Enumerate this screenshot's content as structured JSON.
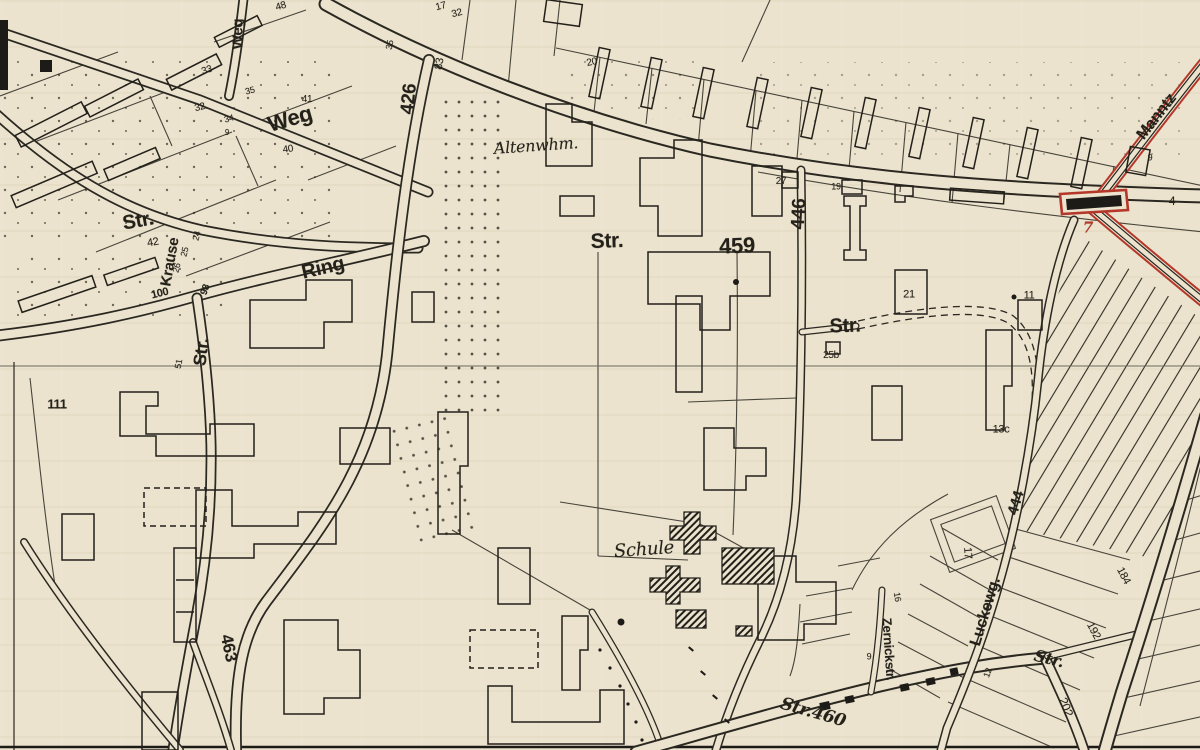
{
  "map": {
    "type": "scanned-city-plan",
    "language": "German",
    "paper_color": "#ebe3cd",
    "ink_color": "#2b2822",
    "highlight_color": "#b4372a",
    "labels": [
      {
        "text": "Weg",
        "x": 238,
        "y": 34,
        "rot": -90,
        "size": 15,
        "bold": true
      },
      {
        "text": "Weg",
        "x": 290,
        "y": 119,
        "rot": -16,
        "size": 22,
        "bold": true
      },
      {
        "text": "Str.",
        "x": 138,
        "y": 221,
        "rot": -10,
        "size": 20,
        "bold": true
      },
      {
        "text": "Krause",
        "x": 170,
        "y": 262,
        "rot": -80,
        "size": 15,
        "bold": true
      },
      {
        "text": "Ring",
        "x": 323,
        "y": 268,
        "rot": -13,
        "size": 20,
        "bold": true
      },
      {
        "text": "Str.",
        "x": 201,
        "y": 352,
        "rot": -84,
        "size": 18,
        "bold": true
      },
      {
        "text": "426",
        "x": 409,
        "y": 99,
        "rot": -84,
        "size": 19,
        "bold": true
      },
      {
        "text": "463",
        "x": 229,
        "y": 648,
        "rot": 78,
        "size": 17,
        "bold": true
      },
      {
        "text": "446",
        "x": 799,
        "y": 214,
        "rot": -87,
        "size": 19,
        "bold": true
      },
      {
        "text": "459",
        "x": 737,
        "y": 246,
        "rot": -2,
        "size": 22,
        "bold": true
      },
      {
        "text": "Str.",
        "x": 607,
        "y": 241,
        "rot": -2,
        "size": 21,
        "bold": true
      },
      {
        "text": "Altenwhm.",
        "x": 536,
        "y": 146,
        "rot": -4,
        "size": 16,
        "italic": true
      },
      {
        "text": "Schule",
        "x": 644,
        "y": 550,
        "rot": -4,
        "size": 18,
        "italic": true
      },
      {
        "text": "Str.",
        "x": 845,
        "y": 326,
        "rot": -2,
        "size": 20,
        "bold": true
      },
      {
        "text": "Str.460",
        "x": 813,
        "y": 713,
        "rot": 16,
        "size": 17,
        "bold": true,
        "italic": true
      },
      {
        "text": "Str.",
        "x": 1049,
        "y": 659,
        "rot": 14,
        "size": 16,
        "bold": true,
        "italic": true
      },
      {
        "text": "Zernickstr.",
        "x": 889,
        "y": 649,
        "rot": 86,
        "size": 13,
        "bold": true
      },
      {
        "text": "Luckewg.",
        "x": 986,
        "y": 612,
        "rot": -73,
        "size": 16,
        "bold": true
      },
      {
        "text": "444",
        "x": 1016,
        "y": 503,
        "rot": -73,
        "size": 15,
        "bold": true
      },
      {
        "text": "Manntz",
        "x": 1157,
        "y": 117,
        "rot": -52,
        "size": 16,
        "bold": true
      },
      {
        "text": "202",
        "x": 1066,
        "y": 707,
        "rot": 68,
        "size": 12
      },
      {
        "text": "192",
        "x": 1093,
        "y": 631,
        "rot": 62,
        "size": 11
      },
      {
        "text": "184",
        "x": 1123,
        "y": 576,
        "rot": 62,
        "size": 11
      },
      {
        "text": "7",
        "x": 1088,
        "y": 228,
        "rot": 0,
        "size": 15,
        "bold": true,
        "italic": true,
        "color": "#b4372a"
      },
      {
        "text": "4",
        "x": 1172,
        "y": 201,
        "rot": 0,
        "size": 12
      },
      {
        "text": "9",
        "x": 1150,
        "y": 158,
        "rot": 0,
        "size": 9
      },
      {
        "text": "111",
        "x": 57,
        "y": 404,
        "rot": 0,
        "size": 13,
        "bold": true
      },
      {
        "text": "51",
        "x": 179,
        "y": 364,
        "rot": -80,
        "size": 9
      },
      {
        "text": "100",
        "x": 160,
        "y": 294,
        "rot": -14,
        "size": 11,
        "bold": true
      },
      {
        "text": "98",
        "x": 206,
        "y": 290,
        "rot": -70,
        "size": 10,
        "bold": true
      },
      {
        "text": "42",
        "x": 153,
        "y": 243,
        "rot": -10,
        "size": 11
      },
      {
        "text": "24",
        "x": 197,
        "y": 236,
        "rot": -75,
        "size": 9
      },
      {
        "text": "25",
        "x": 185,
        "y": 252,
        "rot": -75,
        "size": 9
      },
      {
        "text": "26",
        "x": 177,
        "y": 268,
        "rot": -75,
        "size": 9
      },
      {
        "text": "33",
        "x": 207,
        "y": 71,
        "rot": -18,
        "size": 10
      },
      {
        "text": "32",
        "x": 200,
        "y": 108,
        "rot": -14,
        "size": 10
      },
      {
        "text": "34",
        "x": 229,
        "y": 119,
        "rot": -14,
        "size": 9
      },
      {
        "text": "9",
        "x": 227,
        "y": 133,
        "rot": 0,
        "size": 8
      },
      {
        "text": "35",
        "x": 250,
        "y": 91,
        "rot": -14,
        "size": 9
      },
      {
        "text": "41",
        "x": 307,
        "y": 100,
        "rot": 0,
        "size": 10
      },
      {
        "text": "40",
        "x": 288,
        "y": 150,
        "rot": -8,
        "size": 10
      },
      {
        "text": "48",
        "x": 281,
        "y": 7,
        "rot": -16,
        "size": 10
      },
      {
        "text": "17",
        "x": 441,
        "y": 7,
        "rot": -14,
        "size": 10
      },
      {
        "text": "32",
        "x": 457,
        "y": 14,
        "rot": -14,
        "size": 10
      },
      {
        "text": "83",
        "x": 440,
        "y": 64,
        "rot": -80,
        "size": 11
      },
      {
        "text": "35",
        "x": 390,
        "y": 45,
        "rot": -78,
        "size": 9
      },
      {
        "text": "20",
        "x": 592,
        "y": 63,
        "rot": -12,
        "size": 10
      },
      {
        "text": "27",
        "x": 781,
        "y": 182,
        "rot": 0,
        "size": 10
      },
      {
        "text": "19",
        "x": 836,
        "y": 187,
        "rot": 0,
        "size": 9
      },
      {
        "text": "21",
        "x": 909,
        "y": 295,
        "rot": 0,
        "size": 11
      },
      {
        "text": "25b",
        "x": 831,
        "y": 356,
        "rot": 0,
        "size": 10
      },
      {
        "text": "11",
        "x": 1029,
        "y": 296,
        "rot": 0,
        "size": 11
      },
      {
        "text": "13c",
        "x": 1001,
        "y": 430,
        "rot": 0,
        "size": 11
      },
      {
        "text": "16",
        "x": 897,
        "y": 597,
        "rot": 80,
        "size": 9
      },
      {
        "text": "9",
        "x": 869,
        "y": 657,
        "rot": 0,
        "size": 9
      },
      {
        "text": "17",
        "x": 967,
        "y": 553,
        "rot": 86,
        "size": 11
      },
      {
        "text": "12",
        "x": 988,
        "y": 673,
        "rot": -70,
        "size": 9
      }
    ]
  }
}
